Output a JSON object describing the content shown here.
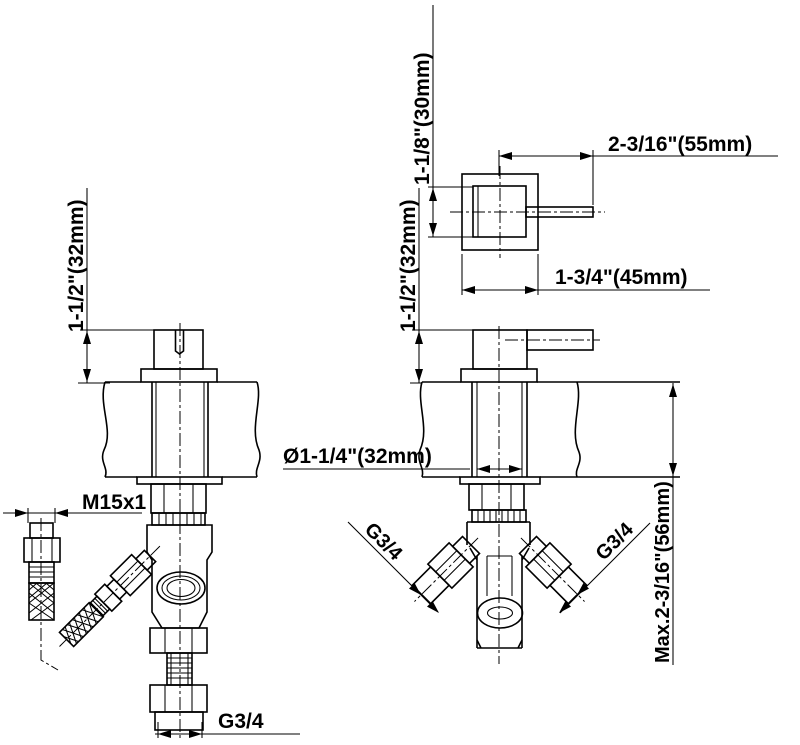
{
  "drawing": {
    "background": "#ffffff",
    "line_color": "#000000",
    "dimensions": {
      "handle_base_height": "1-1/8\"(30mm)",
      "lever_length": "2-3/16\"(55mm)",
      "escutcheon_width": "1-3/4\"(45mm)",
      "projection_left": "1-1/2\"(32mm)",
      "projection_right": "1-1/2\"(32mm)",
      "body_diameter": "Ø1-1/4\"(32mm)",
      "inlet_thread": "M15x1",
      "bottom_outlet_thread": "G3/4",
      "left_outlet_thread": "G3/4",
      "right_outlet_thread": "G3/4",
      "max_wall_thickness": "Max.2-3/16\"(56mm)"
    }
  }
}
